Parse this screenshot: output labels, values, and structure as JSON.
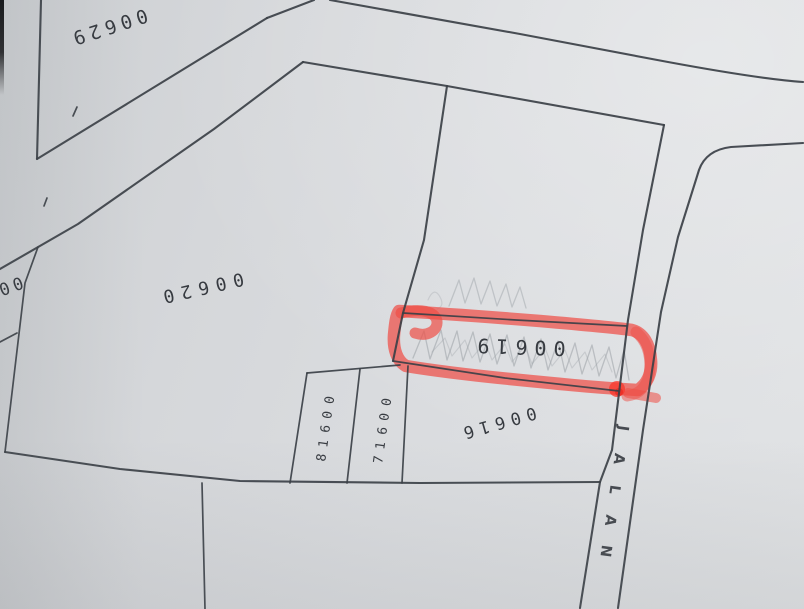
{
  "map": {
    "road": {
      "label": "JALAN"
    },
    "plots": [
      {
        "id": "00629",
        "highlighted": false
      },
      {
        "id": "00620",
        "highlighted": false
      },
      {
        "id": "00619",
        "highlighted": true
      },
      {
        "id": "00616",
        "highlighted": false
      },
      {
        "id": "00618",
        "highlighted": false
      },
      {
        "id": "00617",
        "highlighted": false
      },
      {
        "id": "00",
        "highlighted": false,
        "partial": true
      }
    ],
    "colors": {
      "paper": "#d7d9dc",
      "line": "#3b4046",
      "highlight": "#ee4e46",
      "pencil": "#9aa0a5",
      "text": "#2b2f35"
    }
  }
}
